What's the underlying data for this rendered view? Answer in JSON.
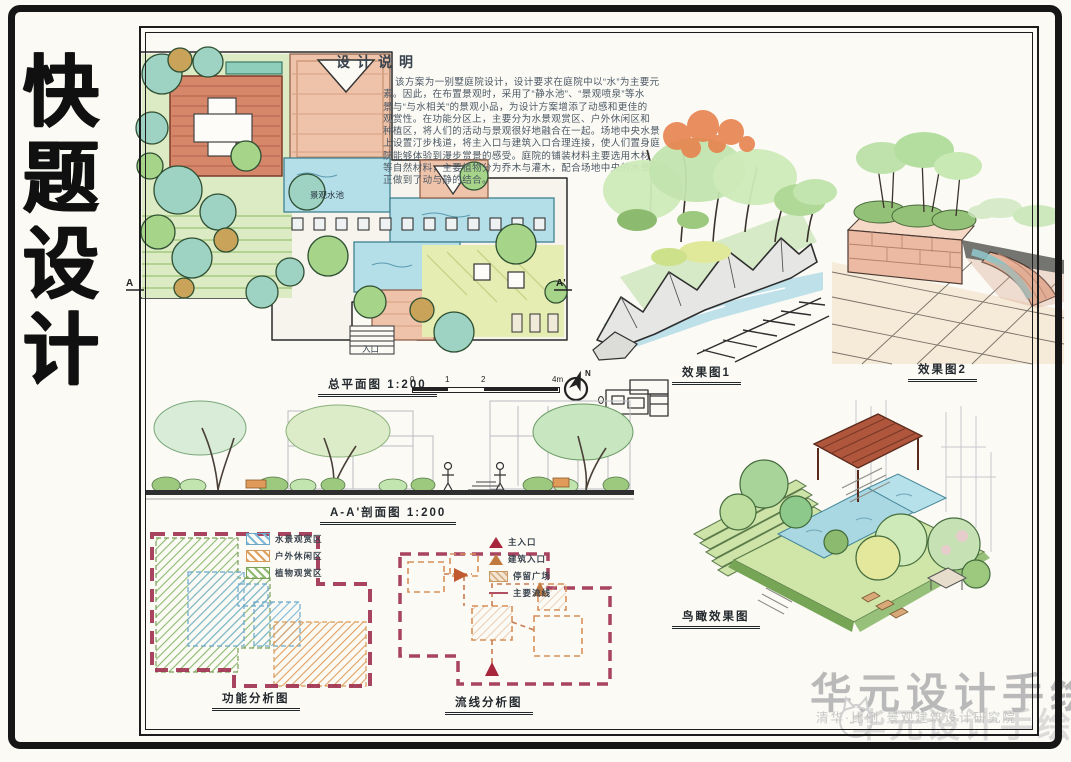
{
  "board": {
    "title_chars": [
      "快",
      "题",
      "设",
      "计"
    ],
    "ink_color": "#1a1a1a",
    "paper_color": "#fbfaf5"
  },
  "design_notes": {
    "heading": "设计说明",
    "lines": [
      "该方案为一别墅庭院设计，设计要求在庭院中以“水”为主要元",
      "素。因此，在布置景观时，采用了“静水池”、“景观喷泉”等水",
      "景与“与水相关”的景观小品，为设计方案增添了动感和更佳的",
      "观赏性。在功能分区上，主要分为水景观赏区、户外休闲区和",
      "种植区，将人们的活动与景观很好地融合在一起。场地中央水景",
      "上设置汀步栈道，将主入口与建筑入口合理连接，使人们置身庭",
      "院能够体验到漫步赏景的感受。庭院的铺装材料主要选用木材",
      "等自然材料，主要植物分为乔木与灌木，配合场地中央的水景真",
      "正做到了动与静的结合。"
    ]
  },
  "site_plan": {
    "caption": "总平面图 1:200",
    "water_label": "景观水池",
    "entrance_label": "入口",
    "section_marker_a": "A",
    "section_marker_a2": "A'",
    "north_label": "N",
    "scale_ticks": [
      "0",
      "1",
      "2",
      "4m"
    ]
  },
  "perspective1": {
    "caption": "效果图1"
  },
  "perspective2": {
    "caption": "效果图2"
  },
  "section": {
    "caption": "A-A'剖面图 1:200"
  },
  "function_analysis": {
    "caption": "功能分析图",
    "boundary_color": "#a13352",
    "legend": [
      {
        "label": "水景观赏区",
        "color": "#7fb8d8"
      },
      {
        "label": "户外休闲区",
        "color": "#e0a060"
      },
      {
        "label": "植物观赏区",
        "color": "#8cba6e"
      }
    ]
  },
  "circulation_analysis": {
    "caption": "流线分析图",
    "legend": [
      {
        "label": "主入口",
        "color": "#a8263c",
        "marker": "triangle"
      },
      {
        "label": "建筑入口",
        "color": "#c07a40",
        "marker": "triangle"
      },
      {
        "label": "停留广场",
        "color": "#e8cdb0",
        "marker": "square"
      },
      {
        "label": "主要流线",
        "color": "#b05060",
        "marker": "line"
      }
    ]
  },
  "birdseye": {
    "caption": "鸟瞰效果图"
  },
  "watermark": {
    "main": "华元设计手绘",
    "sub": "清华·比例·景观建筑设计研究院",
    "overlay": "华元设计手绘",
    "color": "#b9b9b9"
  }
}
